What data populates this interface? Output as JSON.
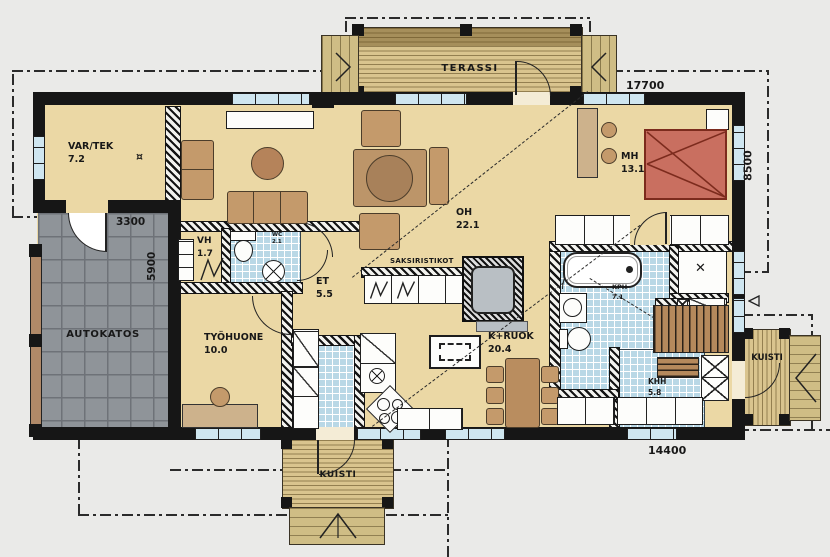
{
  "plan": {
    "title": "house-floor-plan",
    "rooms": {
      "vartek": {
        "name": "VAR/TEK",
        "area": "7.2"
      },
      "oh": {
        "name": "OH",
        "area": "22.1"
      },
      "mh": {
        "name": "MH",
        "area": "13.1"
      },
      "vh": {
        "name": "VH",
        "area": "1.7"
      },
      "wc": {
        "name": "WC",
        "area": "2.1"
      },
      "et": {
        "name": "ET",
        "area": "5.5"
      },
      "tyohuone": {
        "name": "TYÖHUONE",
        "area": "10.0"
      },
      "kruok": {
        "name": "K+RUOK",
        "area": "20.4"
      },
      "kph": {
        "name": "KPH",
        "area": "7.1"
      },
      "khh": {
        "name": "KHH",
        "area": "5.8"
      },
      "autokatos": {
        "name": "AUTOKATOS"
      },
      "terassi": {
        "name": "TERASSI"
      },
      "kuisti_south": {
        "name": "KUISTI"
      },
      "kuisti_east": {
        "name": "KUISTI"
      }
    },
    "dimensions": {
      "overall_width": "17700",
      "overall_depth": "8500",
      "body_width": "14400",
      "carport_width": "3300",
      "carport_depth": "5900"
    },
    "annotations": {
      "truss_note": "SAKSIRISTIKOT"
    },
    "symbols": {
      "floor_drain": "¤",
      "sauna_stove": "✕"
    },
    "colors": {
      "floor": "#ebd8a5",
      "deck": "#d9c48e",
      "tile": "#b9d8e6",
      "carport": "#8f9499",
      "bed": "#c96f60",
      "furniture": "#c49a6b",
      "wall": "#161616",
      "background": "#e9e9e7"
    }
  }
}
